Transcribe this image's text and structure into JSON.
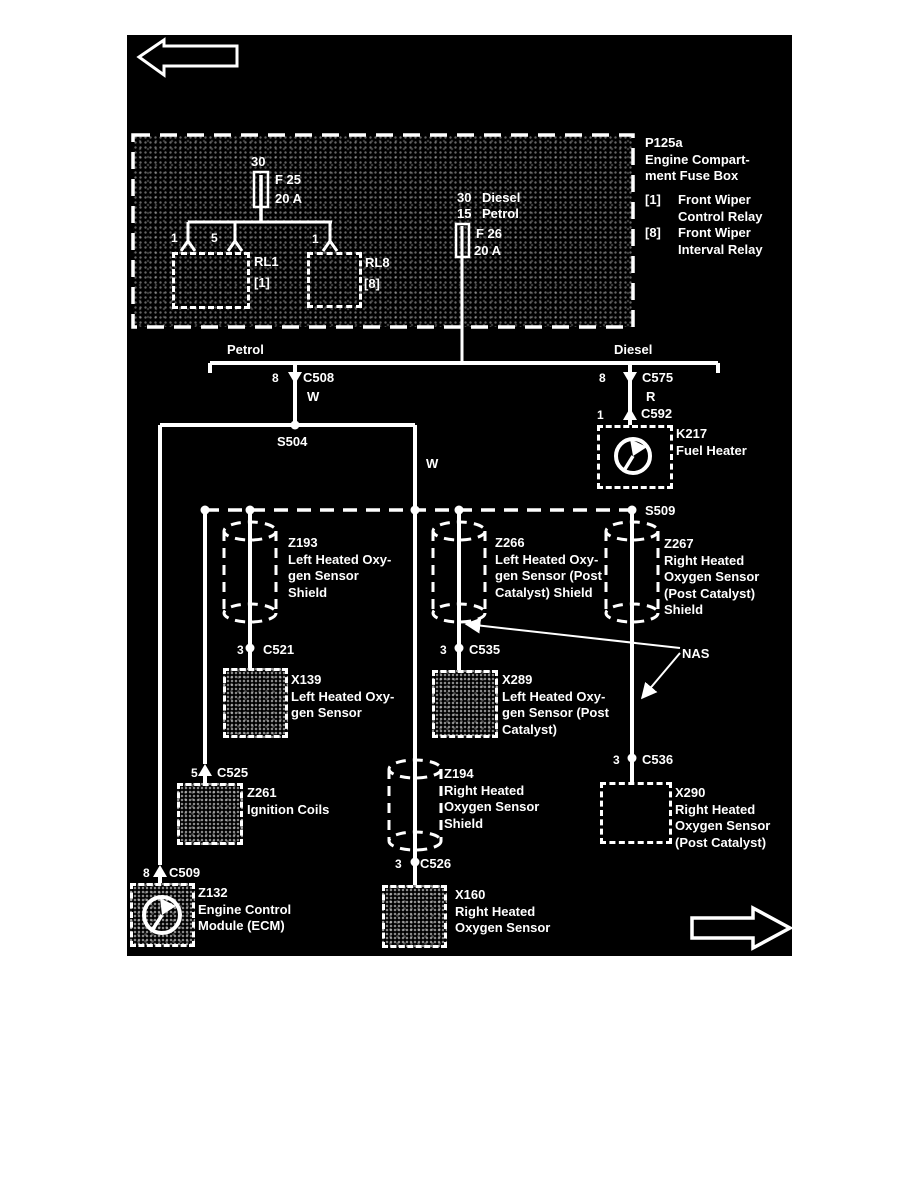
{
  "colors": {
    "diagram_bg": "#000000",
    "line": "#ffffff"
  },
  "icons": {
    "nav_left": "arrow-left",
    "nav_right": "arrow-right",
    "shield": "cylinder",
    "component_symbol": "circle-with-hand",
    "fuse": "rectangle",
    "connector_female": "triangle-down",
    "connector_male": "triangle-up",
    "splice_junction": "dot"
  },
  "fusebox": {
    "legend": {
      "id": "P125a",
      "name_line1": "Engine Compart-",
      "name_line2": "ment Fuse Box",
      "items": [
        {
          "ref": "[1]",
          "line1": "Front Wiper",
          "line2": "Control Relay"
        },
        {
          "ref": "[8]",
          "line1": "Front Wiper",
          "line2": "Interval Relay"
        }
      ]
    },
    "fuse25": {
      "terminal": "30",
      "name": "F 25",
      "rating": "20 A"
    },
    "fuse26": {
      "rows": [
        {
          "num": "30",
          "label": "Diesel"
        },
        {
          "num": "15",
          "label": "Petrol"
        }
      ],
      "name": "F 26",
      "rating": "20 A"
    },
    "relay1": {
      "name": "RL1",
      "ref": "[1]",
      "pins": [
        "1",
        "5"
      ]
    },
    "relay8": {
      "name": "RL8",
      "ref": "[8]",
      "pins": [
        "1"
      ]
    }
  },
  "branches": {
    "left": "Petrol",
    "right": "Diesel"
  },
  "splices": {
    "s504": "S504",
    "s509": "S509"
  },
  "wire_colors": {
    "c508": "W",
    "mid": "W",
    "c575": "R"
  },
  "connectors": {
    "c508": {
      "pin": "8",
      "name": "C508"
    },
    "c575": {
      "pin": "8",
      "name": "C575"
    },
    "c592": {
      "pin": "1",
      "name": "C592"
    },
    "c525": {
      "pin": "5",
      "name": "C525"
    },
    "c509": {
      "pin": "8",
      "name": "C509"
    },
    "c521": {
      "pin": "3",
      "name": "C521"
    },
    "c535": {
      "pin": "3",
      "name": "C535"
    },
    "c526": {
      "pin": "3",
      "name": "C526"
    },
    "c536": {
      "pin": "3",
      "name": "C536"
    }
  },
  "components": {
    "k217": {
      "id": "K217",
      "lines": [
        "Fuel Heater"
      ]
    },
    "z193": {
      "id": "Z193",
      "lines": [
        "Left Heated Oxy-",
        "gen Sensor",
        "Shield"
      ]
    },
    "z266": {
      "id": "Z266",
      "lines": [
        "Left Heated Oxy-",
        "gen Sensor (Post",
        "Catalyst) Shield"
      ]
    },
    "z267": {
      "id": "Z267",
      "lines": [
        "Right Heated",
        "Oxygen Sensor",
        "(Post Catalyst)",
        "Shield"
      ]
    },
    "z194": {
      "id": "Z194",
      "lines": [
        "Right Heated",
        "Oxygen Sensor",
        "Shield"
      ]
    },
    "x139": {
      "id": "X139",
      "lines": [
        "Left Heated Oxy-",
        "gen Sensor"
      ]
    },
    "x289": {
      "id": "X289",
      "lines": [
        "Left Heated Oxy-",
        "gen Sensor (Post",
        "Catalyst)"
      ]
    },
    "x160": {
      "id": "X160",
      "lines": [
        "Right Heated",
        "Oxygen Sensor"
      ]
    },
    "x290": {
      "id": "X290",
      "lines": [
        "Right Heated",
        "Oxygen Sensor",
        "(Post Catalyst)"
      ]
    },
    "z261": {
      "id": "Z261",
      "lines": [
        "Ignition Coils"
      ]
    },
    "z132": {
      "id": "Z132",
      "lines": [
        "Engine Control",
        "Module (ECM)"
      ]
    }
  },
  "annotations": {
    "nas": "NAS"
  }
}
